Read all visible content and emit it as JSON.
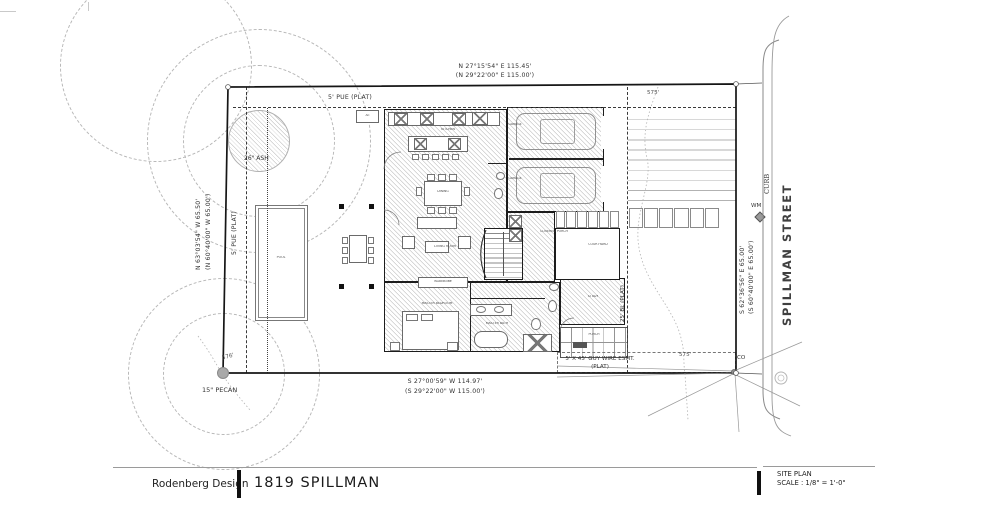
{
  "colors": {
    "line": "#1a1a1a",
    "hatch": "#9a9a9a",
    "street_text": "#3f3f3f",
    "contour": "#b3b3b3"
  },
  "title_block": {
    "firm": "Rodenberg Design",
    "project": "1819 SPILLMAN",
    "sheet": "SITE PLAN",
    "scale": "SCALE : 1/8\" = 1'-0\""
  },
  "survey": {
    "north_bearing": "N 27°15'54\" E  115.45'",
    "north_plat": "(N 29°22'00\" E  115.00')",
    "south_bearing": "S 27°00'59\" W  114.97'",
    "south_plat": "(S 29°22'00\" W  115.00')",
    "west_bearing": "N 63°03'54\" W  65.50'",
    "west_plat": "(N 60°40'00\" W  65.00')",
    "east_bearing": "S 62°36'56\" E  65.00'",
    "east_plat": "(S 60°40'00\" E  65.00')"
  },
  "easements": {
    "pue_top": "5' PUE (PLAT)",
    "pue_left": "5' PUE (PLAT)",
    "building_line": "25' BL (PLAT)",
    "guy_wire_line1": "5' X 45' GUY WIRE ESMT.",
    "guy_wire_line2": "(PLAT)"
  },
  "street": {
    "name": "SPILLMAN STREET",
    "curb": "CURB",
    "water_meter": "WM",
    "cleanout": "CO"
  },
  "trees": {
    "ash": "26\" ASH",
    "pecan": "15\" PECAN"
  },
  "contours": {
    "a": "575'",
    "b": "575'",
    "c": "576'"
  },
  "rooms": {
    "kitchen": "KITCHEN",
    "dining": "DINING",
    "living": "LIVING ROOM",
    "master_bedroom": "MASTER BEDROOM",
    "master_bath": "MASTER BATH",
    "wardrobe": "WARDROBE",
    "garage_a": "GARAGE",
    "garage_b": "GARAGE",
    "covered_porch": "COVERED PORCH",
    "courtyard": "COURTYARD",
    "study": "STUDY",
    "pool": "POOL",
    "entry_porch": "PORCH",
    "ac": "AC"
  }
}
